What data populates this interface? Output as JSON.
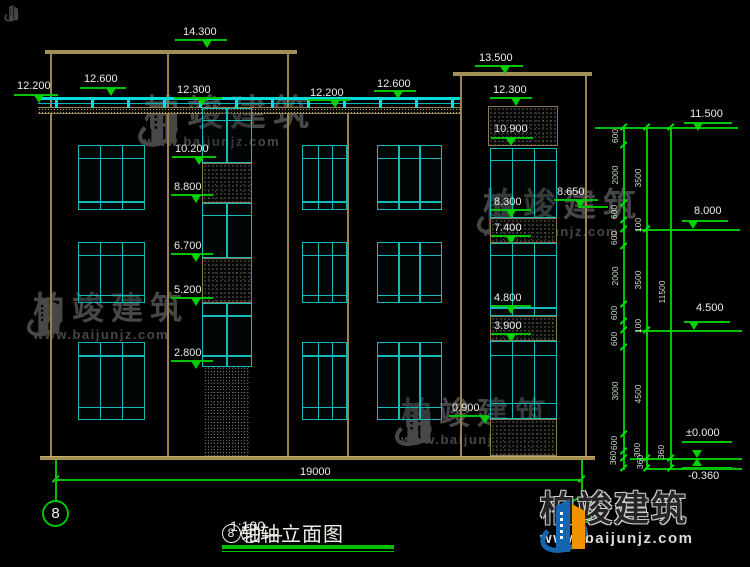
{
  "title_block": {
    "axis_bubble_left": "8",
    "title_axis1": "8",
    "title_seg1": "轴—",
    "title_axis2": "1",
    "title_seg2": "轴立面图",
    "scale": "1:100"
  },
  "brand": {
    "name": "柏竣建筑",
    "url": "www.baijunjz.com"
  },
  "bottom_dimension": {
    "label": "19000"
  },
  "elevation_markers": [
    {
      "t": "14.300",
      "lx": 183,
      "ly": 26,
      "ux": 175,
      "uy": 39,
      "uw": 52,
      "tx": 208,
      "ty": 40
    },
    {
      "t": "12.600",
      "lx": 84,
      "ly": 73,
      "ux": 80,
      "uy": 87,
      "uw": 46,
      "tx": 112,
      "ty": 88
    },
    {
      "t": "12.200",
      "lx": 17,
      "ly": 80,
      "ux": 14,
      "uy": 94,
      "uw": 44,
      "tx": 40,
      "ty": 95
    },
    {
      "t": "12.300",
      "lx": 177,
      "ly": 84,
      "ux": 174,
      "uy": 97,
      "uw": 48,
      "tx": 203,
      "ty": 98
    },
    {
      "t": "12.200",
      "lx": 310,
      "ly": 87,
      "ux": 308,
      "uy": 99,
      "uw": 42,
      "tx": 336,
      "ty": 100
    },
    {
      "t": "12.600",
      "lx": 377,
      "ly": 78,
      "ux": 374,
      "uy": 90,
      "uw": 42,
      "tx": 399,
      "ty": 91
    },
    {
      "t": "13.500",
      "lx": 479,
      "ly": 52,
      "ux": 475,
      "uy": 65,
      "uw": 48,
      "tx": 506,
      "ty": 66
    },
    {
      "t": "12.300",
      "lx": 493,
      "ly": 84,
      "ux": 490,
      "uy": 97,
      "uw": 42,
      "tx": 517,
      "ty": 98
    },
    {
      "t": "10.900",
      "lx": 494,
      "ly": 123,
      "ux": 491,
      "uy": 137,
      "uw": 42,
      "tx": 512,
      "ty": 138
    },
    {
      "t": "10.200",
      "lx": 175,
      "ly": 143,
      "ux": 172,
      "uy": 156,
      "uw": 44,
      "tx": 200,
      "ty": 157
    },
    {
      "t": "8.800",
      "lx": 174,
      "ly": 181,
      "ux": 171,
      "uy": 194,
      "uw": 42,
      "tx": 197,
      "ty": 195
    },
    {
      "t": "8.300",
      "lx": 494,
      "ly": 196,
      "ux": 491,
      "uy": 209,
      "uw": 40,
      "tx": 512,
      "ty": 210
    },
    {
      "t": "7.400",
      "lx": 494,
      "ly": 222,
      "ux": 491,
      "uy": 235,
      "uw": 40,
      "tx": 512,
      "ty": 236
    },
    {
      "t": "6.700",
      "lx": 174,
      "ly": 240,
      "ux": 171,
      "uy": 253,
      "uw": 42,
      "tx": 197,
      "ty": 254
    },
    {
      "t": "5.200",
      "lx": 174,
      "ly": 284,
      "ux": 171,
      "uy": 297,
      "uw": 42,
      "tx": 197,
      "ty": 298
    },
    {
      "t": "4.800",
      "lx": 494,
      "ly": 292,
      "ux": 491,
      "uy": 305,
      "uw": 40,
      "tx": 512,
      "ty": 306
    },
    {
      "t": "3.900",
      "lx": 494,
      "ly": 320,
      "ux": 491,
      "uy": 333,
      "uw": 40,
      "tx": 512,
      "ty": 334
    },
    {
      "t": "2.800",
      "lx": 174,
      "ly": 347,
      "ux": 171,
      "uy": 360,
      "uw": 42,
      "tx": 197,
      "ty": 361
    },
    {
      "t": "0.900",
      "lx": 452,
      "ly": 402,
      "ux": 449,
      "uy": 415,
      "uw": 40,
      "tx": 486,
      "ty": 416
    },
    {
      "t": "8.650",
      "lx": 557,
      "ly": 186,
      "ux": 554,
      "uy": 199,
      "uw": 44,
      "tx": 581,
      "ty": 200
    },
    {
      "t": "11.500",
      "lx": 690,
      "ly": 108,
      "ux": 684,
      "uy": 122,
      "uw": 48,
      "tx": 699,
      "ty": 123
    },
    {
      "t": "8.000",
      "lx": 694,
      "ly": 205,
      "ux": 682,
      "uy": 220,
      "uw": 46,
      "tx": 694,
      "ty": 221
    },
    {
      "t": "4.500",
      "lx": 696,
      "ly": 302,
      "ux": 684,
      "uy": 321,
      "uw": 46,
      "tx": 695,
      "ty": 322
    },
    {
      "t": "±0.000",
      "lx": 686,
      "ly": 427,
      "ux": 682,
      "uy": 441,
      "uw": 50,
      "tx": 698,
      "ty": 450
    },
    {
      "t": "-0.360",
      "lx": 688,
      "ly": 470,
      "ux": 682,
      "uy": 467,
      "uw": 50,
      "tx": 698,
      "ty": 458,
      "up": true
    }
  ],
  "level_lines": [
    {
      "x": 595,
      "y": 127,
      "w": 143
    },
    {
      "x": 636,
      "y": 229,
      "w": 104
    },
    {
      "x": 636,
      "y": 330,
      "w": 106
    },
    {
      "x": 630,
      "y": 458,
      "w": 112
    },
    {
      "x": 648,
      "y": 468,
      "w": 94
    },
    {
      "x": 578,
      "y": 206,
      "w": 30
    }
  ],
  "dim_chains": {
    "verticals": [
      {
        "x": 623,
        "y": 127,
        "h": 343
      },
      {
        "x": 646,
        "y": 127,
        "h": 343
      },
      {
        "x": 670,
        "y": 127,
        "h": 343
      }
    ],
    "ticks": [
      {
        "x": 623,
        "ys": [
          127,
          145,
          203,
          220,
          229,
          246,
          304,
          321,
          330,
          347,
          434,
          451,
          458,
          468
        ]
      },
      {
        "x": 646,
        "ys": [
          127,
          229,
          330,
          458,
          468
        ]
      },
      {
        "x": 670,
        "ys": [
          127,
          458,
          468
        ]
      }
    ],
    "labels": [
      {
        "x": 615,
        "y": 136,
        "t": "600"
      },
      {
        "x": 615,
        "y": 175,
        "t": "2000"
      },
      {
        "x": 614,
        "y": 212,
        "t": "600"
      },
      {
        "x": 614,
        "y": 238,
        "t": "600"
      },
      {
        "x": 615,
        "y": 276,
        "t": "2000"
      },
      {
        "x": 614,
        "y": 313,
        "t": "600"
      },
      {
        "x": 614,
        "y": 339,
        "t": "600"
      },
      {
        "x": 615,
        "y": 391,
        "t": "3000"
      },
      {
        "x": 614,
        "y": 443,
        "t": "600"
      },
      {
        "x": 613,
        "y": 458,
        "t": "360"
      },
      {
        "x": 638,
        "y": 178,
        "t": "3500"
      },
      {
        "x": 638,
        "y": 225,
        "t": "100"
      },
      {
        "x": 638,
        "y": 280,
        "t": "3500"
      },
      {
        "x": 638,
        "y": 326,
        "t": "100"
      },
      {
        "x": 638,
        "y": 394,
        "t": "4500"
      },
      {
        "x": 637,
        "y": 450,
        "t": "300"
      },
      {
        "x": 640,
        "y": 462,
        "t": "360"
      },
      {
        "x": 662,
        "y": 292,
        "t": "11500"
      },
      {
        "x": 661,
        "y": 452,
        "t": "360"
      }
    ]
  },
  "figure": {
    "roofs": [
      {
        "x": 45,
        "y": 50,
        "w": 252,
        "h": 4
      },
      {
        "x": 453,
        "y": 72,
        "w": 139,
        "h": 4
      }
    ],
    "walls": [
      {
        "x": 50,
        "y": 54,
        "h": 402
      },
      {
        "x": 167,
        "y": 54,
        "h": 402
      },
      {
        "x": 287,
        "y": 54,
        "h": 402
      },
      {
        "x": 347,
        "y": 112,
        "h": 344
      },
      {
        "x": 460,
        "y": 76,
        "h": 380
      },
      {
        "x": 585,
        "y": 76,
        "h": 380
      }
    ],
    "ground": {
      "x": 40,
      "y": 456,
      "w": 555,
      "h": 4
    },
    "slab_band": {
      "x": 38,
      "y": 107,
      "w": 422,
      "h": 7
    },
    "railing": {
      "x": 38,
      "y": 97,
      "w": 422,
      "post_step": 36
    },
    "windows": [
      {
        "x": 78,
        "y": 145,
        "w": 67,
        "h": 65,
        "v": [
          0.33,
          0.67
        ],
        "hl": [
          0.2,
          0.89
        ]
      },
      {
        "x": 78,
        "y": 242,
        "w": 67,
        "h": 61,
        "v": [
          0.33,
          0.67
        ],
        "hl": [
          0.21,
          0.89
        ]
      },
      {
        "x": 78,
        "y": 342,
        "w": 67,
        "h": 78,
        "v": [
          0.33,
          0.67
        ],
        "hl": [
          0.17,
          0.85
        ]
      },
      {
        "x": 302,
        "y": 145,
        "w": 45,
        "h": 65,
        "v": [
          0.36,
          0.69
        ],
        "hl": [
          0.2,
          0.89
        ]
      },
      {
        "x": 302,
        "y": 242,
        "w": 45,
        "h": 61,
        "v": [
          0.36,
          0.69
        ],
        "hl": [
          0.21,
          0.89
        ]
      },
      {
        "x": 302,
        "y": 342,
        "w": 45,
        "h": 78,
        "v": [
          0.36,
          0.69
        ],
        "hl": [
          0.17,
          0.85
        ]
      },
      {
        "x": 377,
        "y": 145,
        "w": 65,
        "h": 65,
        "v": [
          0.33,
          0.67
        ],
        "hl": [
          0.2,
          0.89
        ]
      },
      {
        "x": 377,
        "y": 242,
        "w": 65,
        "h": 61,
        "v": [
          0.33,
          0.67
        ],
        "hl": [
          0.21,
          0.89
        ]
      },
      {
        "x": 377,
        "y": 342,
        "w": 65,
        "h": 78,
        "v": [
          0.33,
          0.67
        ],
        "hl": [
          0.17,
          0.85
        ]
      },
      {
        "x": 202,
        "y": 108,
        "w": 50,
        "h": 55,
        "v": [
          0.5
        ],
        "hl": [
          0.22
        ]
      },
      {
        "x": 202,
        "y": 203,
        "w": 50,
        "h": 55,
        "v": [
          0.5
        ],
        "hl": [
          0.22
        ]
      },
      {
        "x": 202,
        "y": 303,
        "w": 50,
        "h": 64,
        "v": [
          0.5
        ],
        "hl": [
          0.19,
          0.84
        ]
      },
      {
        "x": 490,
        "y": 148,
        "w": 67,
        "h": 70,
        "v": [
          0.33,
          0.67
        ],
        "hl": [
          0.17
        ]
      },
      {
        "x": 490,
        "y": 243,
        "w": 67,
        "h": 73,
        "v": [
          0.33,
          0.67
        ],
        "hl": [
          0.16,
          0.9
        ]
      },
      {
        "x": 490,
        "y": 341,
        "w": 67,
        "h": 78,
        "v": [
          0.33,
          0.67
        ],
        "hl": [
          0.18,
          0.81
        ]
      }
    ],
    "hatches": [
      {
        "x": 202,
        "y": 163,
        "w": 50,
        "h": 40
      },
      {
        "x": 202,
        "y": 258,
        "w": 50,
        "h": 45
      },
      {
        "x": 204,
        "y": 367,
        "w": 46,
        "h": 89,
        "dark": true
      },
      {
        "x": 488,
        "y": 106,
        "w": 70,
        "h": 40
      },
      {
        "x": 490,
        "y": 218,
        "w": 67,
        "h": 25
      },
      {
        "x": 490,
        "y": 316,
        "w": 67,
        "h": 25
      },
      {
        "x": 490,
        "y": 419,
        "w": 67,
        "h": 37
      }
    ],
    "bottom_dim": {
      "x1": 55,
      "x2": 581,
      "y": 479,
      "label_x": 300,
      "label_y": 466,
      "extensions": [
        {
          "x": 55,
          "y": 461,
          "h": 25
        },
        {
          "x": 581,
          "y": 461,
          "h": 37
        }
      ]
    },
    "axis_stems": [
      {
        "x": 55,
        "y": 460,
        "h": 41
      },
      {
        "x": 581,
        "y": 460,
        "h": 38
      }
    ],
    "axis_bubbles": [
      {
        "x": 42,
        "y": 500,
        "d": 27,
        "label": "8"
      },
      {
        "x": 568,
        "y": 497,
        "d": 27,
        "label": ""
      }
    ]
  },
  "watermarks": [
    {
      "x": 4,
      "y": 3,
      "glyph": 20,
      "chars": 0,
      "url": 0,
      "mini": true
    },
    {
      "x": 137,
      "y": 95,
      "glyph": 56,
      "chars": 36,
      "url": 13
    },
    {
      "x": 26,
      "y": 292,
      "glyph": 48,
      "chars": 32,
      "url": 13
    },
    {
      "x": 476,
      "y": 188,
      "glyph": 50,
      "chars": 33,
      "url": 13
    },
    {
      "x": 394,
      "y": 398,
      "glyph": 52,
      "chars": 31,
      "url": 13
    }
  ]
}
